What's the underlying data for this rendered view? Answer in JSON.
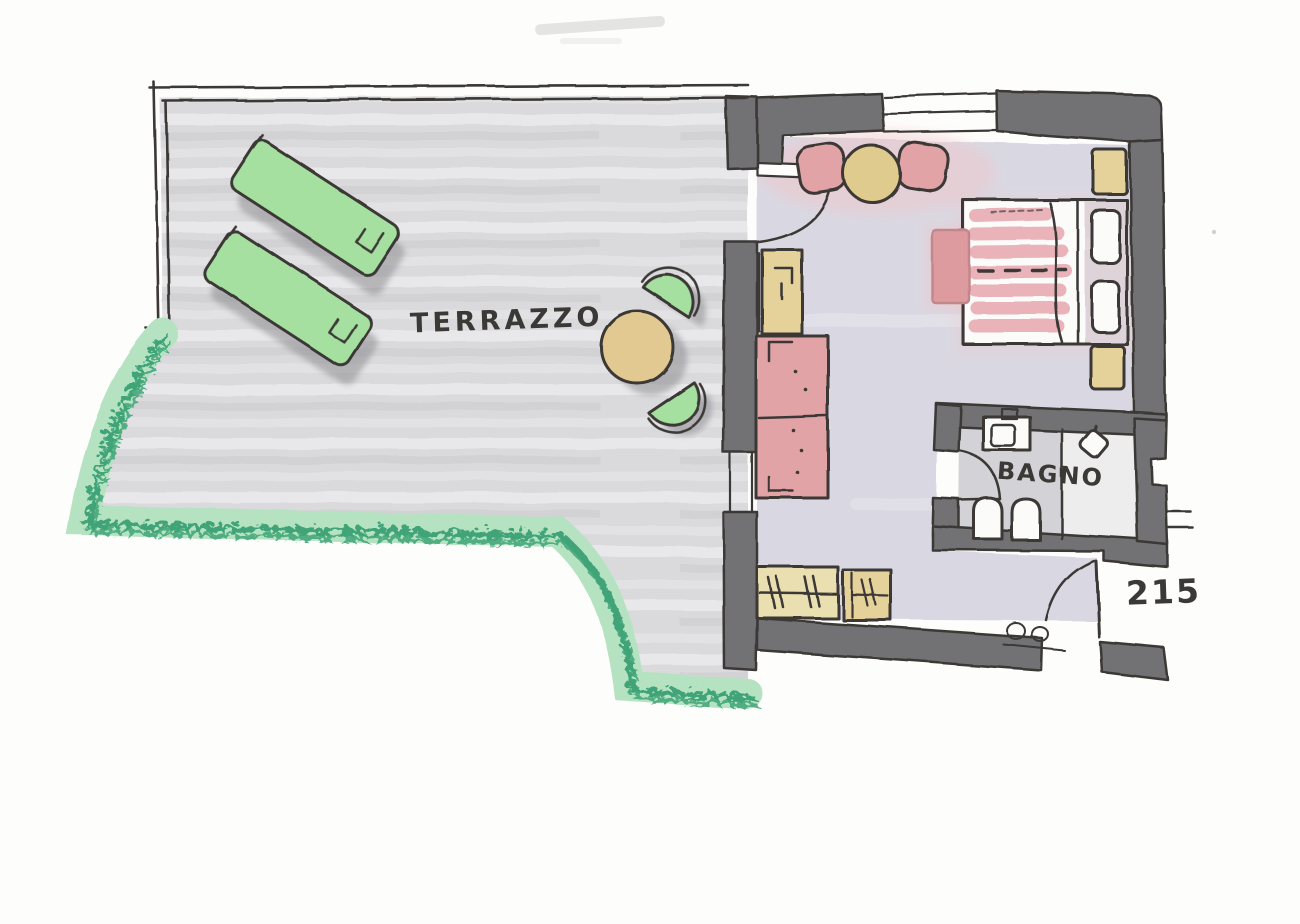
{
  "document": {
    "type": "hand-drawn floor plan sketch (marker on paper)",
    "room_number": "215"
  },
  "labels": {
    "terrace": "TERRAZZO",
    "bathroom": "BAGNO",
    "room_number": "215"
  },
  "legend": {
    "terrace_furniture": [
      "sun-lounger",
      "sun-lounger",
      "round-bistro-table",
      "garden-chair",
      "garden-chair"
    ],
    "bedroom_furniture": [
      "double-bed",
      "pillow",
      "pillow",
      "nightstand",
      "nightstand",
      "foot-bench",
      "two-seat-sofa",
      "minibar-cabinet",
      "armchair",
      "armchair",
      "round-coffee-table",
      "wardrobe-with-hangers",
      "luggage-cabinet"
    ],
    "bathroom_fixtures": [
      "washbasin",
      "toilet",
      "bidet",
      "shower"
    ],
    "openings": [
      "terrace-door",
      "bathroom-door",
      "entrance-door",
      "window",
      "window"
    ],
    "landscaping": [
      "hedge-border"
    ]
  },
  "colors": {
    "paper": "#fdfdfb",
    "ink": "#3b3936",
    "wall": "#727275",
    "terrace_floor": "#dadadd",
    "room_floor": "#d9d8e2",
    "bath_floor": "#d3d3d7",
    "shower_floor": "#ededee",
    "hedge_light": "#b5e2c1",
    "hedge_dark": "#3fa478",
    "furniture_green": "#a6e0a0",
    "shadow": "#85858a",
    "table_tan": "#e2c891",
    "cabinet_tan": "#e5d29b",
    "wardrobe_tan": "#eadfb0",
    "pink": "#e2a3a6",
    "pink_soft": "#f0c6c9",
    "bed_stripe": "#e9b3b9",
    "bench_pink": "#dd9ba0",
    "table_yellow": "#decb8d",
    "white_fixture": "#fbfbf9"
  }
}
